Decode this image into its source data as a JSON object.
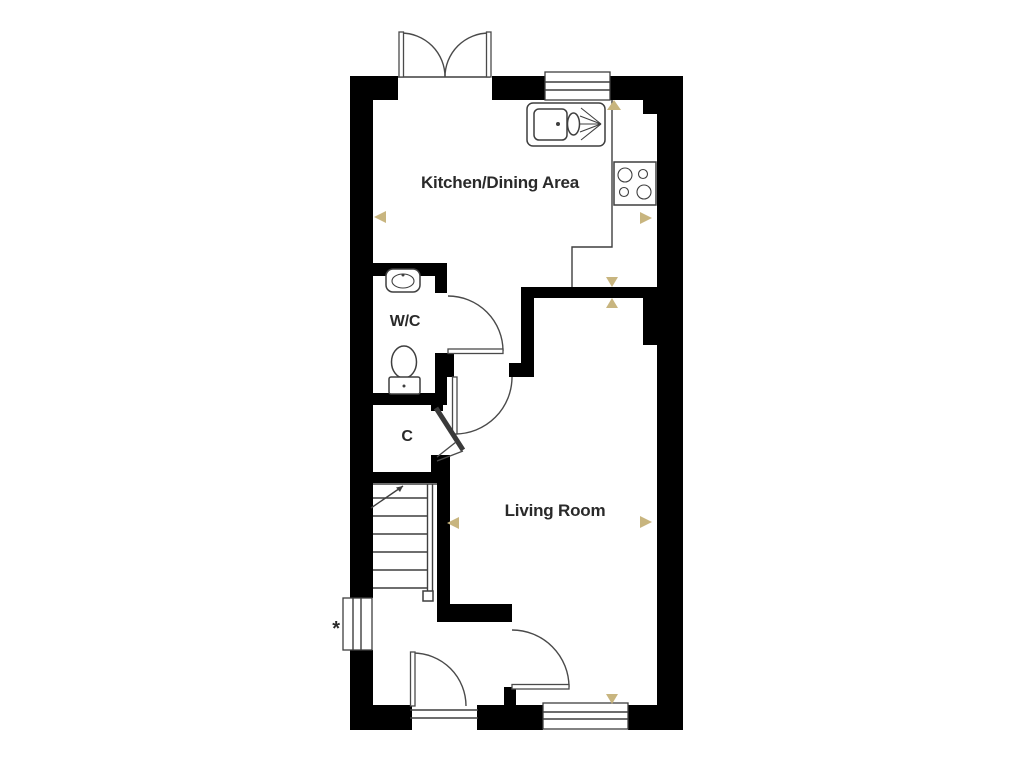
{
  "floorplan": {
    "rooms": [
      {
        "id": "kitchen-dining",
        "label": "Kitchen/Dining Area"
      },
      {
        "id": "wc",
        "label": "W/C"
      },
      {
        "id": "cupboard",
        "label": "C"
      },
      {
        "id": "living-room",
        "label": "Living Room"
      }
    ],
    "annotations": {
      "window_note": "*"
    },
    "fixtures": [
      "sink-drainer-icon",
      "hob-icon",
      "basin-icon",
      "toilet-icon",
      "staircase",
      "french-doors",
      "front-door",
      "windows"
    ],
    "colors": {
      "wall": "#000000",
      "line": "#3f3f3f",
      "door": "#4a4a4a",
      "marker": "#c8b57f",
      "text": "#2a2a2a",
      "bg": "#ffffff"
    }
  }
}
